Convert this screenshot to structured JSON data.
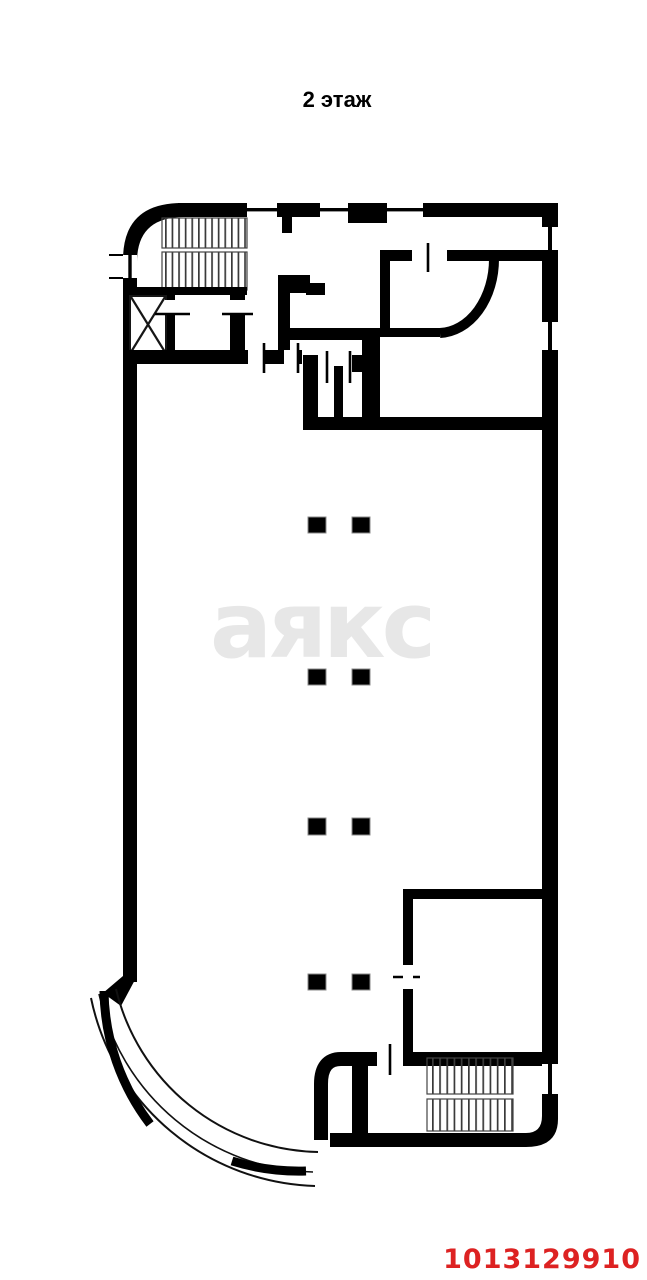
{
  "page": {
    "background_color": "#ffffff"
  },
  "header": {
    "floor_title": "2 этаж"
  },
  "watermark": {
    "text": "аякс",
    "color": "#e7e7e7"
  },
  "footer": {
    "listing_id": "1013129910",
    "color": "#dd2222"
  },
  "plan": {
    "wall_color": "#000000",
    "column_count": 8,
    "features": [
      "staircase-top-left",
      "elevator-shaft",
      "wc-stalls",
      "curved-wall-room",
      "open-hall-with-columns",
      "room-bottom-right",
      "staircase-bottom-right",
      "curved-glass-terrace"
    ]
  }
}
